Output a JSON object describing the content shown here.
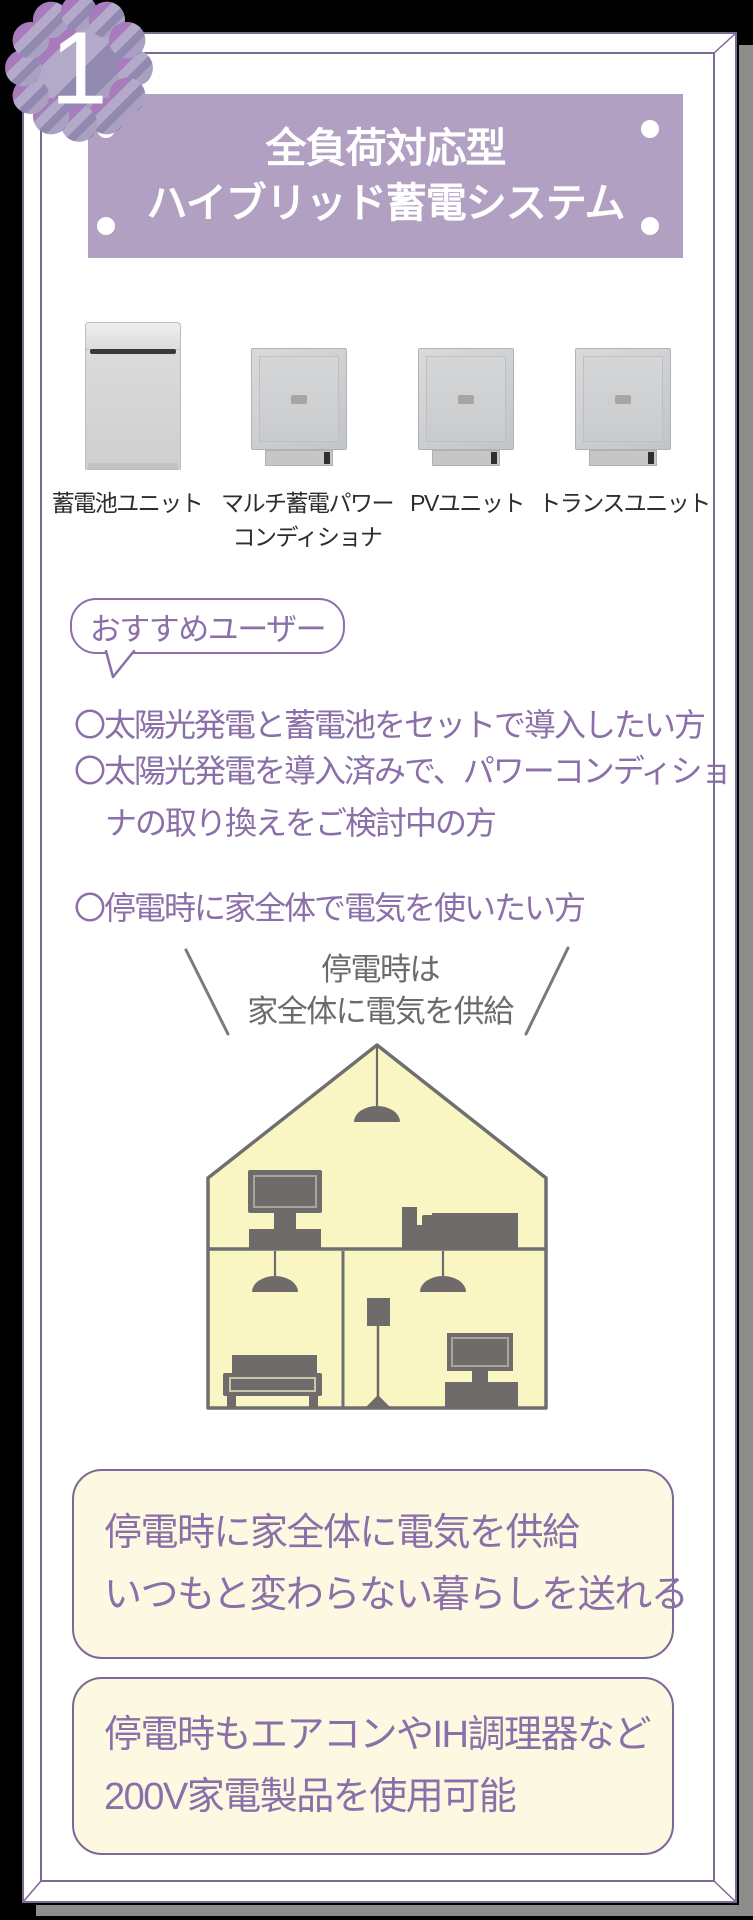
{
  "badge": {
    "number": "1"
  },
  "header": {
    "title_line1": "全負荷対応型",
    "title_line2": "ハイブリッド蓄電システム"
  },
  "products": [
    {
      "label_lines": [
        "蓄電池ユニット"
      ]
    },
    {
      "label_lines": [
        "マルチ蓄電パワー",
        "コンディショナ"
      ]
    },
    {
      "label_lines": [
        "PVユニット"
      ]
    },
    {
      "label_lines": [
        "トランスユニット"
      ]
    }
  ],
  "recommend": {
    "label": "おすすめユーザー",
    "bullets": [
      {
        "lines": [
          "〇太陽光発電と蓄電池をセットで導入したい方"
        ]
      },
      {
        "lines": [
          "〇太陽光発電を導入済みで、パワーコンディショ",
          "ナの取り換えをご検討中の方"
        ]
      },
      {
        "lines": [
          "〇停電時に家全体で電気を使いたい方"
        ]
      }
    ]
  },
  "illustration": {
    "caption_line1": "停電時は",
    "caption_line2": "家全体に電気を供給"
  },
  "benefits": [
    {
      "line1": "停電時に家全体に電気を供給",
      "line2": "いつもと変わらない暮らしを送れる"
    },
    {
      "line1": "停電時もエアコンやIH調理器など",
      "line2": "200V家電製品を使用可能"
    }
  ],
  "colors": {
    "accent_purple": "#8a6fa8",
    "header_bg": "#b2a0c3",
    "cream_bg": "#fcf8e2",
    "house_fill": "#f9f6c4",
    "furniture_gray": "#6f6b6b",
    "outline_gray": "#6f6f6f",
    "frame_purple": "#7c6a94",
    "shadow_gray": "#8c8e8c"
  }
}
